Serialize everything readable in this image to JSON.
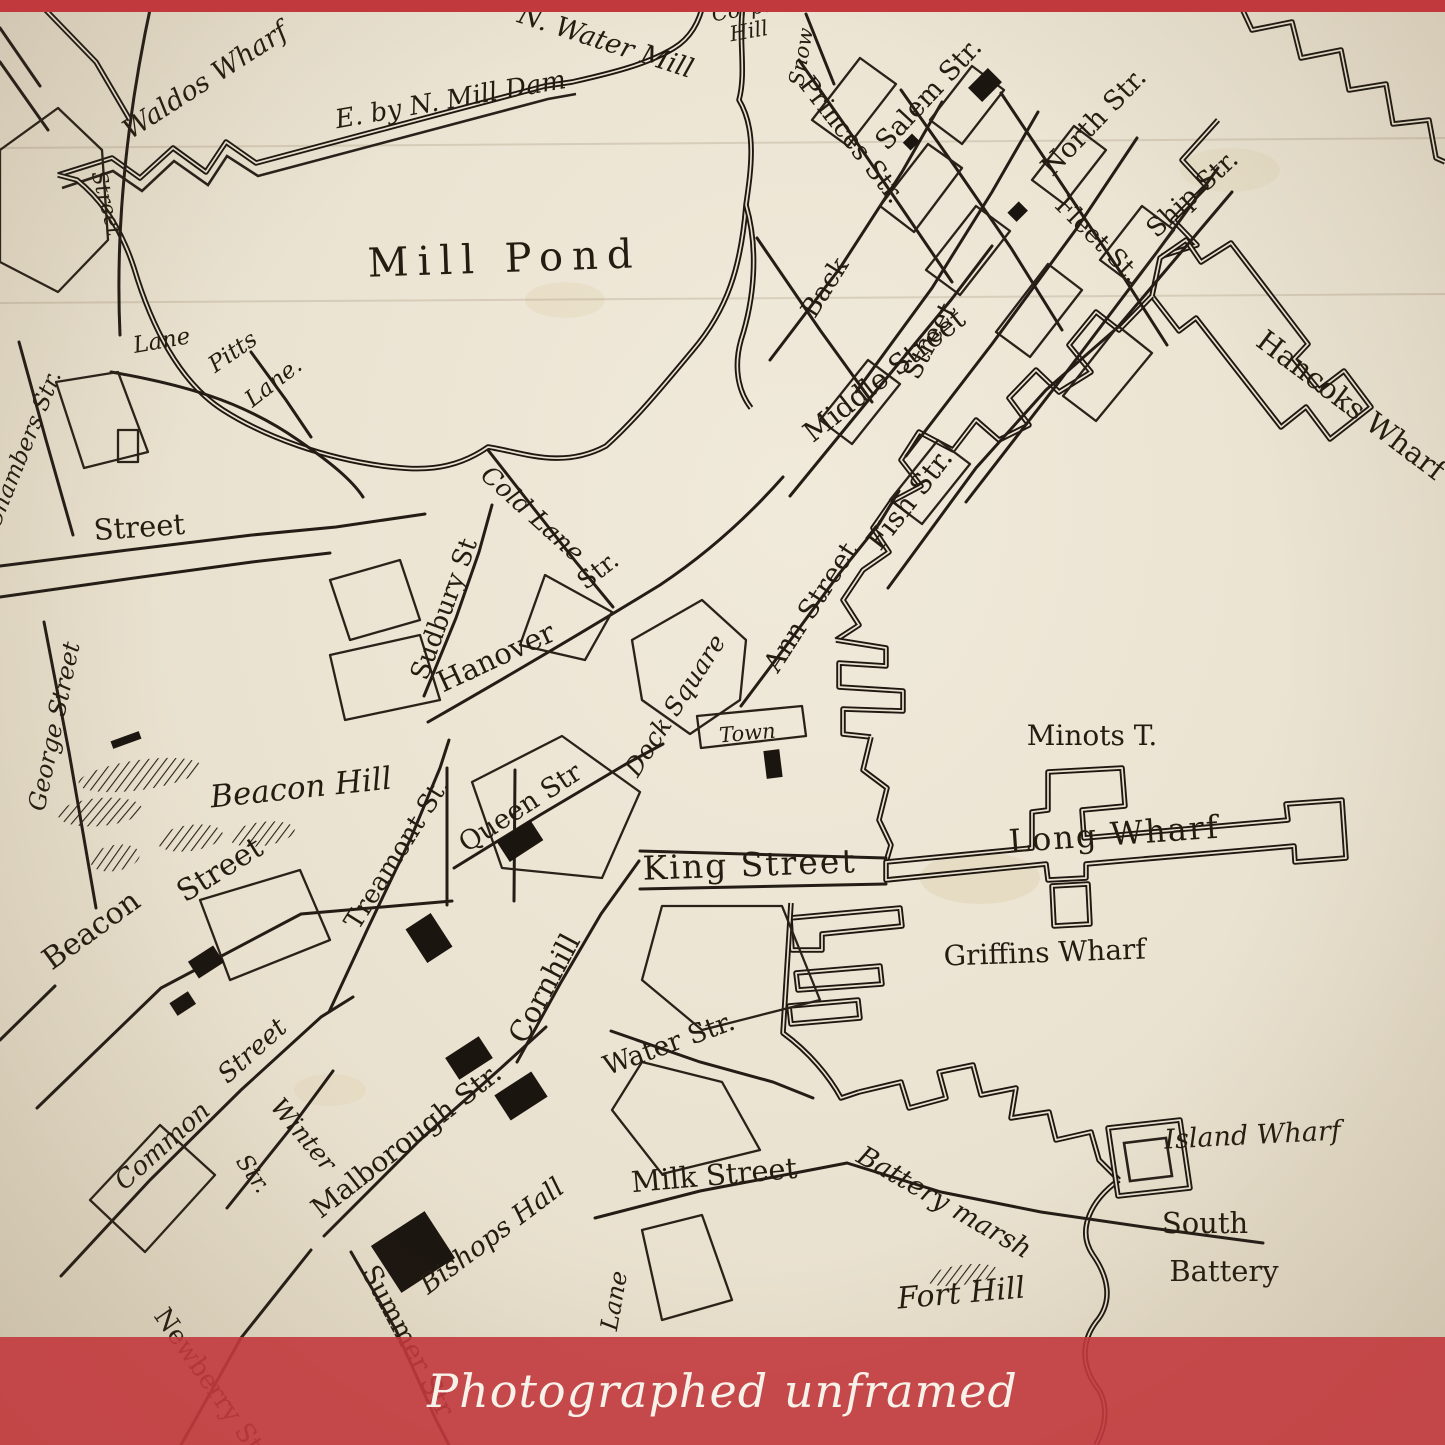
{
  "banner": {
    "caption": "Photographed unframed",
    "background": "#c2393d",
    "overlay_alpha": 0.9,
    "text_color": "#f7f2e9"
  },
  "map": {
    "ink_color": "#241c10",
    "paper_color": "#eae2d0",
    "labels": [
      {
        "text": "Waldos Wharf",
        "x": 210,
        "y": 88,
        "rot": -33,
        "size": 27,
        "style": "script"
      },
      {
        "text": "N. Water Mill",
        "x": 603,
        "y": 50,
        "rot": 18,
        "size": 27,
        "style": "script"
      },
      {
        "text": "E. by N. Mill Dam",
        "x": 452,
        "y": 108,
        "rot": -10,
        "size": 26,
        "style": "script"
      },
      {
        "text": "Corps",
        "x": 744,
        "y": 16,
        "rot": -10,
        "size": 21,
        "style": "script"
      },
      {
        "text": "Hill",
        "x": 750,
        "y": 38,
        "rot": -10,
        "size": 21,
        "style": "script"
      },
      {
        "text": "Snow",
        "x": 808,
        "y": 58,
        "rot": -80,
        "size": 21,
        "style": "script"
      },
      {
        "text": "Princes Str.",
        "x": 845,
        "y": 145,
        "rot": 52,
        "size": 26,
        "style": "roman"
      },
      {
        "text": "Salem Str.",
        "x": 935,
        "y": 100,
        "rot": -47,
        "size": 27,
        "style": "roman"
      },
      {
        "text": "Back",
        "x": 832,
        "y": 292,
        "rot": -58,
        "size": 26,
        "style": "roman"
      },
      {
        "text": "Street",
        "x": 937,
        "y": 345,
        "rot": -62,
        "size": 26,
        "style": "roman"
      },
      {
        "text": "Middle Street",
        "x": 890,
        "y": 383,
        "rot": -38,
        "size": 28,
        "style": "roman"
      },
      {
        "text": "North Str.",
        "x": 1100,
        "y": 128,
        "rot": -46,
        "size": 27,
        "style": "roman"
      },
      {
        "text": "Fleet St.",
        "x": 1092,
        "y": 245,
        "rot": 45,
        "size": 25,
        "style": "roman"
      },
      {
        "text": "Ship Str.",
        "x": 1198,
        "y": 200,
        "rot": -43,
        "size": 26,
        "style": "roman"
      },
      {
        "text": "Hancoks Wharf",
        "x": 1345,
        "y": 413,
        "rot": 37,
        "size": 29,
        "style": "roman"
      },
      {
        "text": "Fish Str.",
        "x": 917,
        "y": 505,
        "rot": -52,
        "size": 28,
        "style": "roman"
      },
      {
        "text": "Chambers Str.",
        "x": 30,
        "y": 452,
        "rot": -68,
        "size": 23,
        "style": "script"
      },
      {
        "text": "Lane",
        "x": 163,
        "y": 348,
        "rot": -10,
        "size": 23,
        "style": "script"
      },
      {
        "text": "Pitts",
        "x": 237,
        "y": 358,
        "rot": -35,
        "size": 23,
        "style": "script"
      },
      {
        "text": "Lane.",
        "x": 278,
        "y": 388,
        "rot": -38,
        "size": 23,
        "style": "script"
      },
      {
        "text": "Street",
        "x": 140,
        "y": 537,
        "rot": -4,
        "size": 29,
        "style": "roman"
      },
      {
        "text": "Street",
        "x": 100,
        "y": 205,
        "rot": 75,
        "size": 21,
        "style": "script"
      },
      {
        "text": "George Street",
        "x": 62,
        "y": 728,
        "rot": -78,
        "size": 24,
        "style": "script"
      },
      {
        "text": "Beacon Hill",
        "x": 302,
        "y": 798,
        "rot": -6,
        "size": 31,
        "style": "script"
      },
      {
        "text": "Beacon",
        "x": 97,
        "y": 938,
        "rot": -36,
        "size": 30,
        "style": "roman"
      },
      {
        "text": "Street",
        "x": 225,
        "y": 878,
        "rot": -32,
        "size": 30,
        "style": "roman"
      },
      {
        "text": "Treamont St.",
        "x": 404,
        "y": 858,
        "rot": -58,
        "size": 26,
        "style": "roman"
      },
      {
        "text": "Queen Str",
        "x": 525,
        "y": 815,
        "rot": -33,
        "size": 27,
        "style": "roman"
      },
      {
        "text": "King Street",
        "x": 750,
        "y": 876,
        "rot": -2,
        "size": 33,
        "style": "roman",
        "spacing": 2
      },
      {
        "text": "Cornhill",
        "x": 553,
        "y": 993,
        "rot": -62,
        "size": 29,
        "style": "roman"
      },
      {
        "text": "Water Str.",
        "x": 672,
        "y": 1052,
        "rot": -20,
        "size": 27,
        "style": "roman"
      },
      {
        "text": "Milk Street",
        "x": 715,
        "y": 1185,
        "rot": -5,
        "size": 29,
        "style": "roman"
      },
      {
        "text": "Battery marsh",
        "x": 940,
        "y": 1210,
        "rot": 30,
        "size": 27,
        "style": "script"
      },
      {
        "text": "Fort Hill",
        "x": 962,
        "y": 1303,
        "rot": -5,
        "size": 30,
        "style": "script"
      },
      {
        "text": "Island Wharf",
        "x": 1253,
        "y": 1144,
        "rot": -3,
        "size": 27,
        "style": "script"
      },
      {
        "text": "South",
        "x": 1205,
        "y": 1233,
        "rot": 0,
        "size": 29,
        "style": "roman"
      },
      {
        "text": "Battery",
        "x": 1224,
        "y": 1281,
        "rot": 0,
        "size": 29,
        "style": "roman"
      },
      {
        "text": "Minots T.",
        "x": 1092,
        "y": 745,
        "rot": 0,
        "size": 28,
        "style": "roman"
      },
      {
        "text": "Long Wharf",
        "x": 1115,
        "y": 845,
        "rot": -4,
        "size": 32,
        "style": "roman",
        "spacing": 2
      },
      {
        "text": "Griffins Wharf",
        "x": 1045,
        "y": 962,
        "rot": -2,
        "size": 28,
        "style": "roman"
      },
      {
        "text": "Sudbury St",
        "x": 452,
        "y": 612,
        "rot": -70,
        "size": 26,
        "style": "roman"
      },
      {
        "text": "Cold Lane",
        "x": 527,
        "y": 520,
        "rot": 42,
        "size": 25,
        "style": "script"
      },
      {
        "text": "Hanover",
        "x": 500,
        "y": 666,
        "rot": -25,
        "size": 29,
        "style": "roman"
      },
      {
        "text": "Str.",
        "x": 603,
        "y": 577,
        "rot": -38,
        "size": 25,
        "style": "roman"
      },
      {
        "text": "Dock Square",
        "x": 682,
        "y": 710,
        "rot": -57,
        "size": 25,
        "style": "script"
      },
      {
        "text": "Town",
        "x": 748,
        "y": 740,
        "rot": -5,
        "size": 21,
        "style": "script"
      },
      {
        "text": "Ann Street",
        "x": 818,
        "y": 612,
        "rot": -57,
        "size": 27,
        "style": "roman"
      },
      {
        "text": "Mill Pond",
        "x": 505,
        "y": 272,
        "rot": -2,
        "size": 40,
        "style": "roman",
        "spacing": 9
      },
      {
        "text": "Common",
        "x": 168,
        "y": 1152,
        "rot": -42,
        "size": 26,
        "style": "script"
      },
      {
        "text": "Street",
        "x": 258,
        "y": 1057,
        "rot": -42,
        "size": 26,
        "style": "script"
      },
      {
        "text": "Winter",
        "x": 297,
        "y": 1140,
        "rot": 50,
        "size": 25,
        "style": "script"
      },
      {
        "text": "Str.",
        "x": 247,
        "y": 1178,
        "rot": 55,
        "size": 23,
        "style": "script"
      },
      {
        "text": "Malborough Str.",
        "x": 412,
        "y": 1148,
        "rot": -38,
        "size": 28,
        "style": "roman"
      },
      {
        "text": "Bishops Hall",
        "x": 497,
        "y": 1243,
        "rot": -37,
        "size": 27,
        "style": "script"
      },
      {
        "text": "Summer Str",
        "x": 400,
        "y": 1345,
        "rot": 62,
        "size": 27,
        "style": "roman"
      },
      {
        "text": "Newberry Str",
        "x": 205,
        "y": 1390,
        "rot": 55,
        "size": 26,
        "style": "roman"
      },
      {
        "text": "Lane",
        "x": 622,
        "y": 1302,
        "rot": -80,
        "size": 24,
        "style": "script"
      }
    ]
  }
}
